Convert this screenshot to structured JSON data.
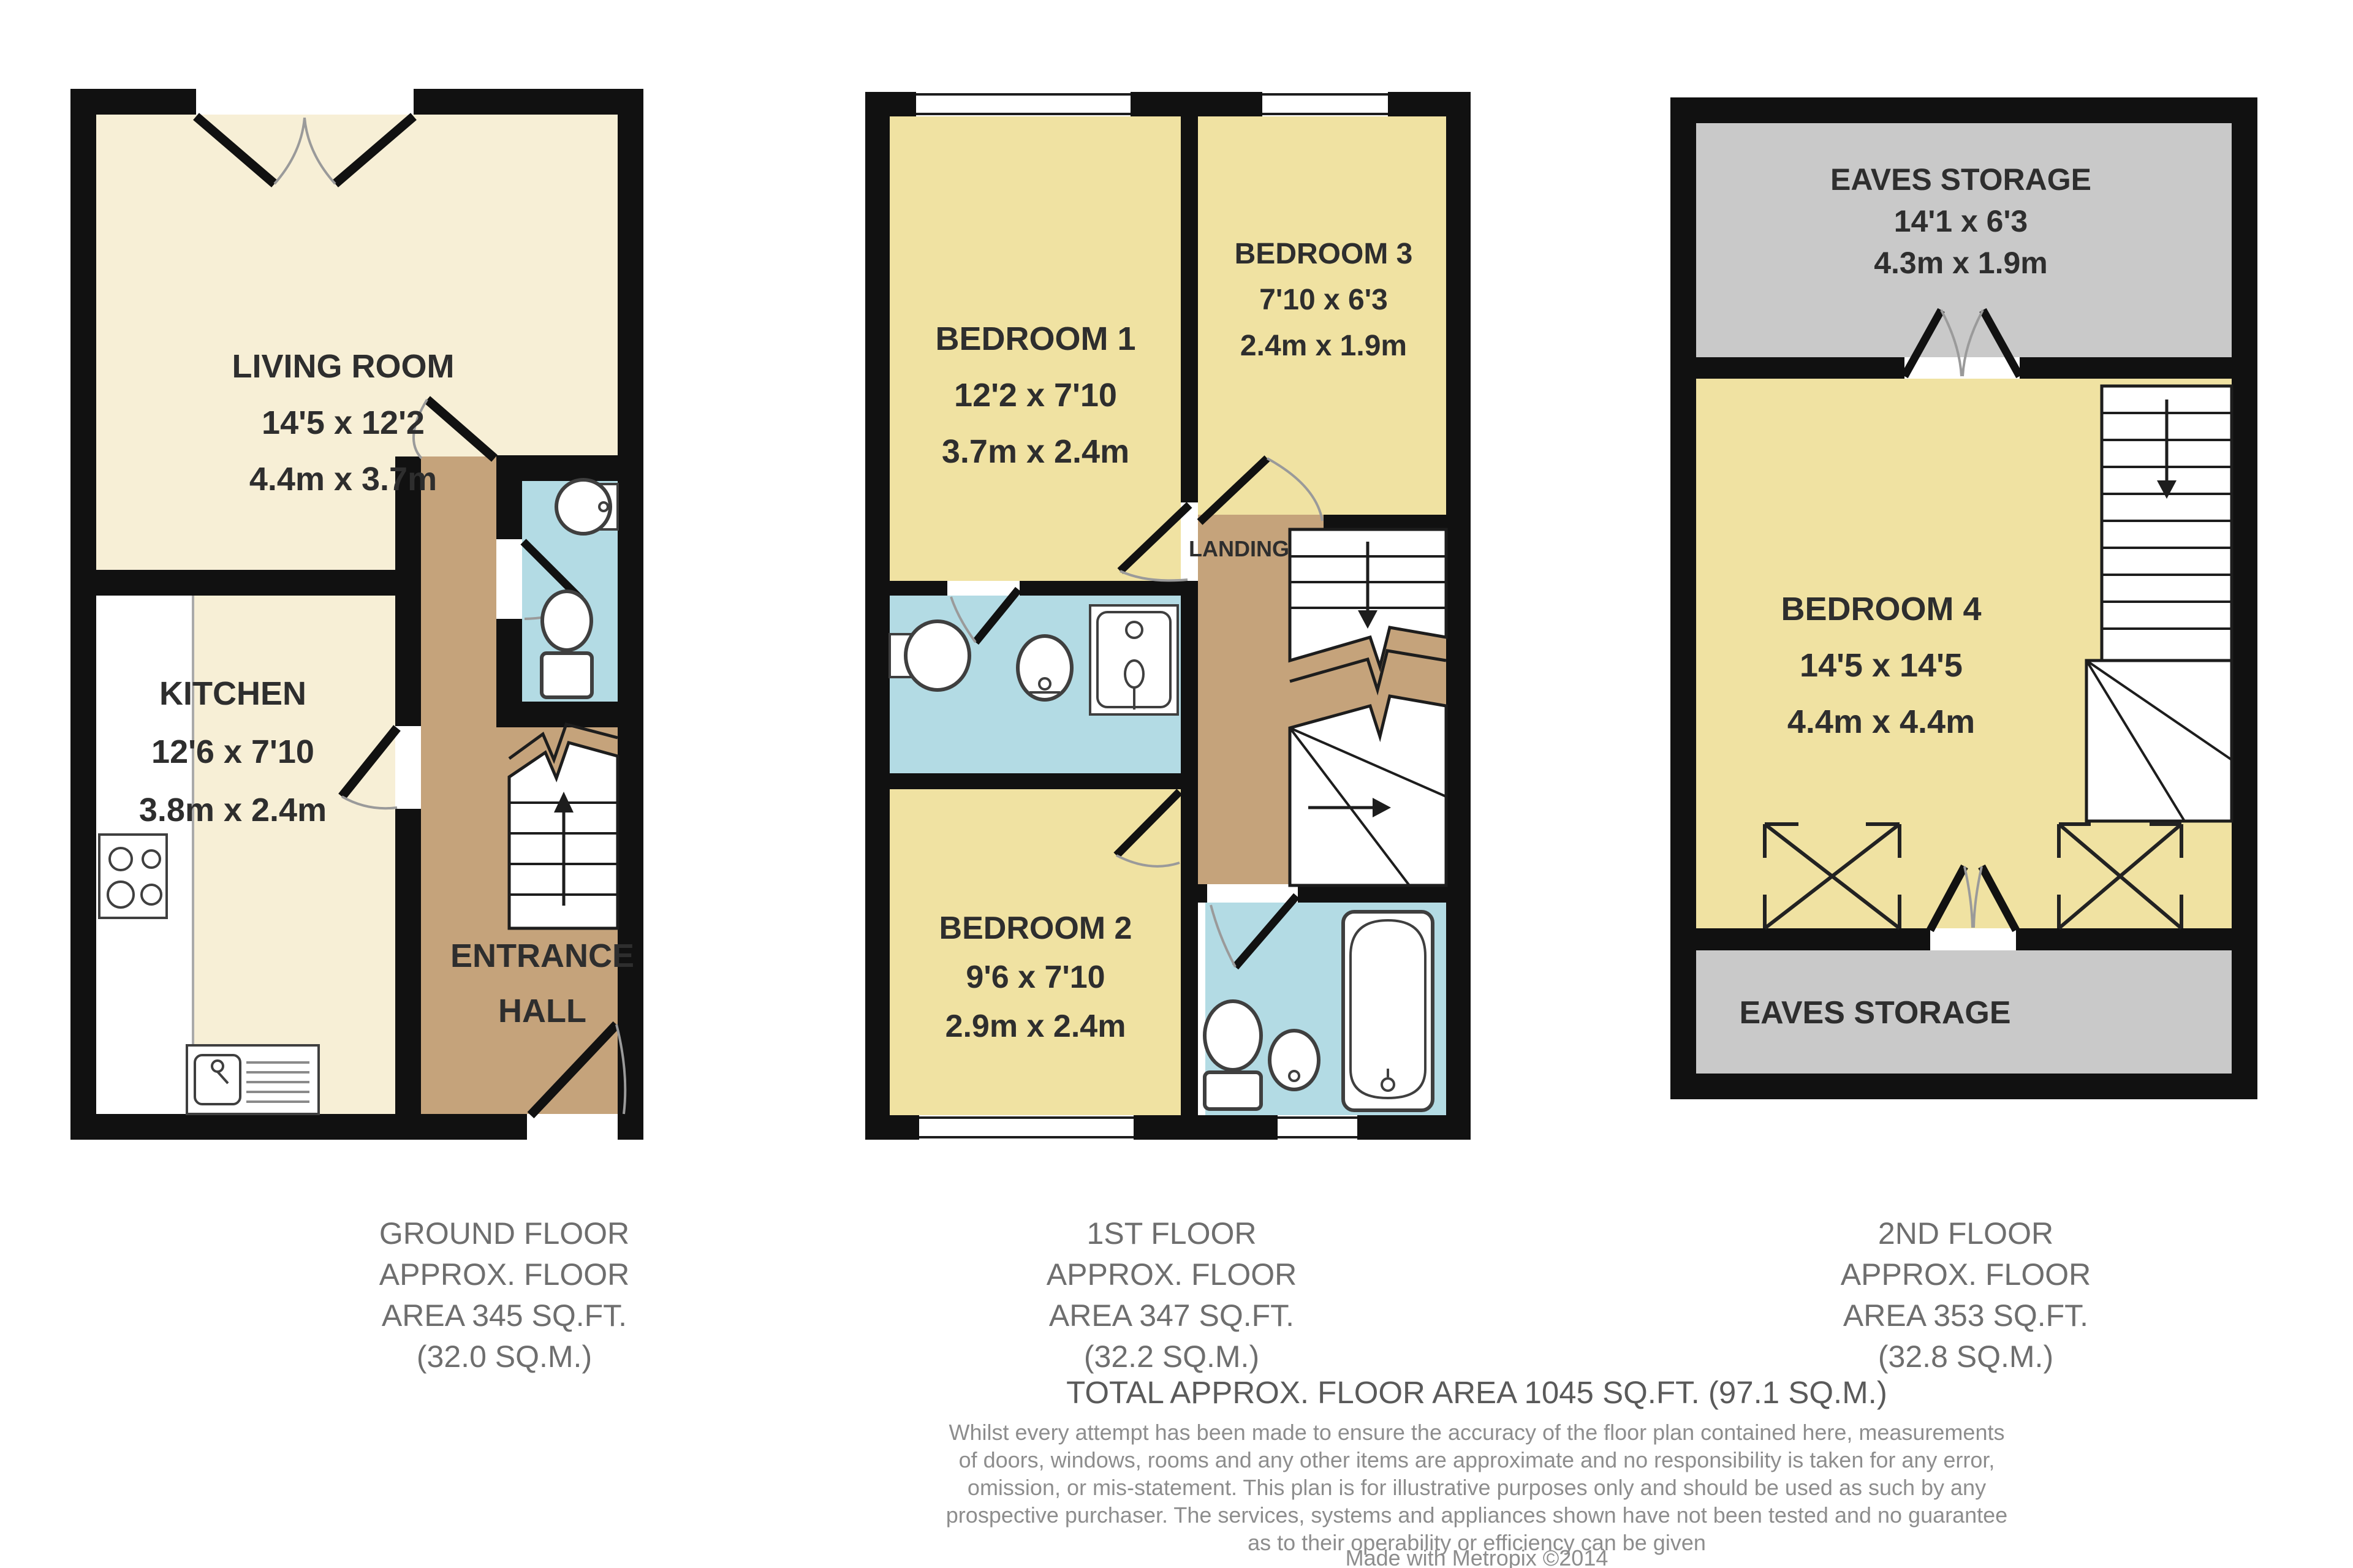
{
  "document_type": "floorplan",
  "colors": {
    "cream": "#f7efd6",
    "yellow": "#f0e2a2",
    "tan": "#c5a37b",
    "blue": "#b3dbe4",
    "grey": "#c9c9c9",
    "wall": "#111111",
    "page": "#ffffff"
  },
  "rooms": {
    "living": {
      "name": "LIVING ROOM",
      "imperial": "14'5 x 12'2",
      "metric": "4.4m x 3.7m"
    },
    "kitchen": {
      "name": "KITCHEN",
      "imperial": "12'6 x 7'10",
      "metric": "3.8m x 2.4m"
    },
    "hall": {
      "line1": "ENTRANCE",
      "line2": "HALL"
    },
    "bed1": {
      "name": "BEDROOM 1",
      "imperial": "12'2 x 7'10",
      "metric": "3.7m x 2.4m"
    },
    "bed3": {
      "name": "BEDROOM 3",
      "imperial": "7'10 x 6'3",
      "metric": "2.4m x 1.9m"
    },
    "bed2": {
      "name": "BEDROOM 2",
      "imperial": "9'6 x 7'10",
      "metric": "2.9m x 2.4m"
    },
    "landing": {
      "name": "LANDING"
    },
    "bed4": {
      "name": "BEDROOM 4",
      "imperial": "14'5 x 14'5",
      "metric": "4.4m x 4.4m"
    },
    "eaves_top": {
      "name": "EAVES STORAGE",
      "imperial": "14'1 x 6'3",
      "metric": "4.3m x 1.9m"
    },
    "eaves_bottom": {
      "name": "EAVES STORAGE"
    }
  },
  "captions": {
    "ground": [
      "GROUND FLOOR",
      "APPROX. FLOOR",
      "AREA 345 SQ.FT.",
      "(32.0 SQ.M.)"
    ],
    "first": [
      "1ST FLOOR",
      "APPROX. FLOOR",
      "AREA 347 SQ.FT.",
      "(32.2 SQ.M.)"
    ],
    "second": [
      "2ND FLOOR",
      "APPROX. FLOOR",
      "AREA 353 SQ.FT.",
      "(32.8 SQ.M.)"
    ]
  },
  "total_line": "TOTAL APPROX. FLOOR AREA 1045 SQ.FT. (97.1 SQ.M.)",
  "disclaimer": [
    "Whilst every attempt has been made to ensure the accuracy of the floor plan contained here, measurements",
    "of doors, windows, rooms and any other items are approximate and no responsibility is taken for any error,",
    "omission, or mis-statement. This plan is for illustrative purposes only and should be used as such by any",
    "prospective purchaser. The services, systems and appliances shown have not been tested and no guarantee",
    "as to their operability or efficiency can be given",
    "Made with Metropix ©2014"
  ]
}
